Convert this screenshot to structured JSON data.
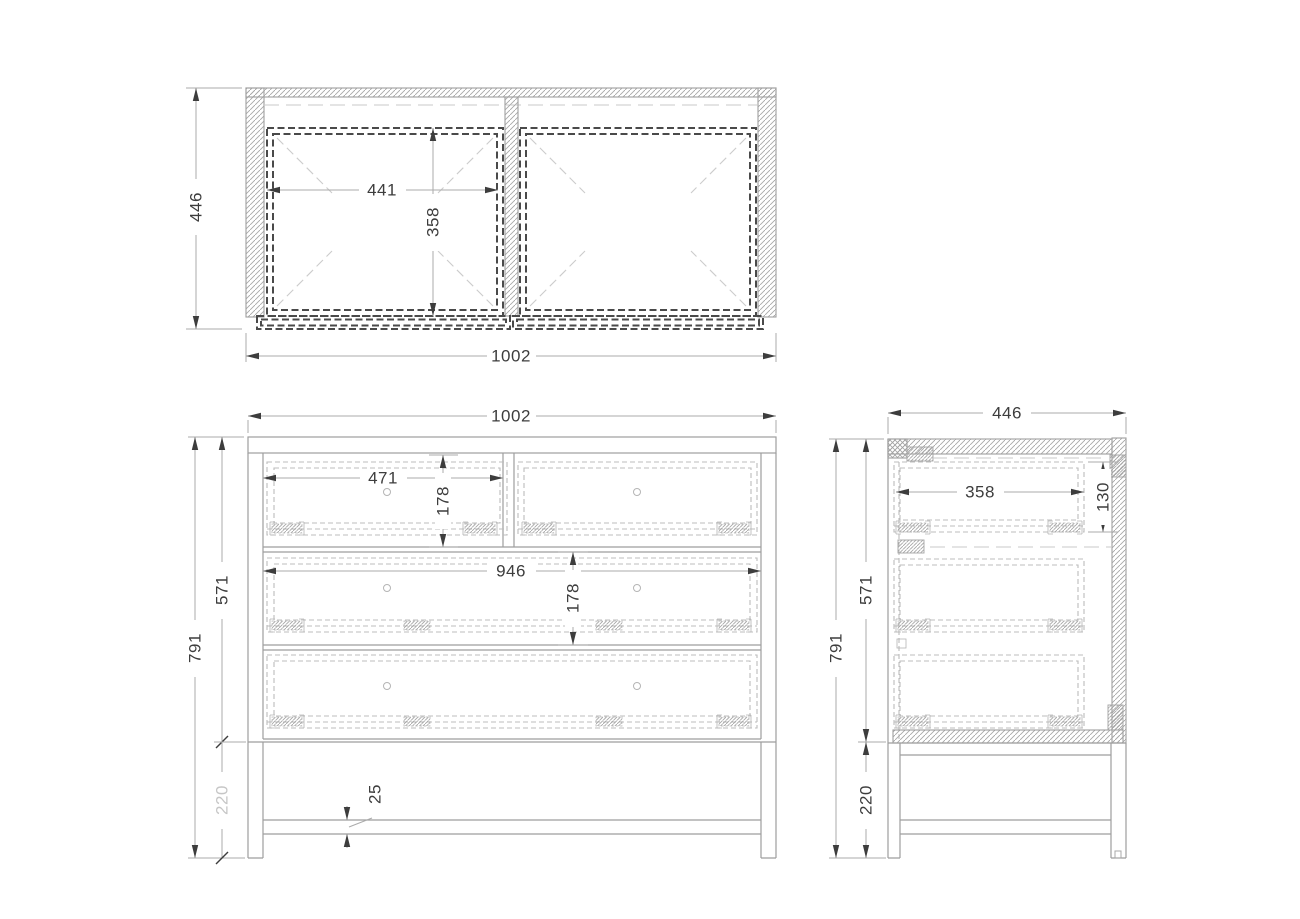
{
  "drawing": {
    "type": "furniture-orthographic-technical-drawing",
    "subject": "three-drawer-chest",
    "colors": {
      "background": "#ffffff",
      "structure_line": "#9e9e9e",
      "dim_text": "#3d3d3d",
      "dim_line": "#ababab",
      "light_dim_text": "#c6c6c6",
      "drawer_box_dash": "#4a4a4a",
      "drawer_front_dash": "#bcbcbc",
      "hidden_line": "#c9c9c9"
    }
  },
  "dims": {
    "top": {
      "depth": "446",
      "width": "1002",
      "drawer_inner_width": "441",
      "drawer_inner_depth": "358"
    },
    "front": {
      "width": "1002",
      "height": "791",
      "carcass_height": "571",
      "base_height": "220",
      "top_drawer_width": "471",
      "top_drawer_height": "178",
      "wide_drawer_width": "946",
      "middle_drawer_height": "178",
      "stretcher_thickness": "25"
    },
    "side": {
      "depth": "446",
      "height": "791",
      "carcass_height": "571",
      "base_height": "220",
      "drawer_depth": "358",
      "drawer_side_height": "130"
    }
  }
}
